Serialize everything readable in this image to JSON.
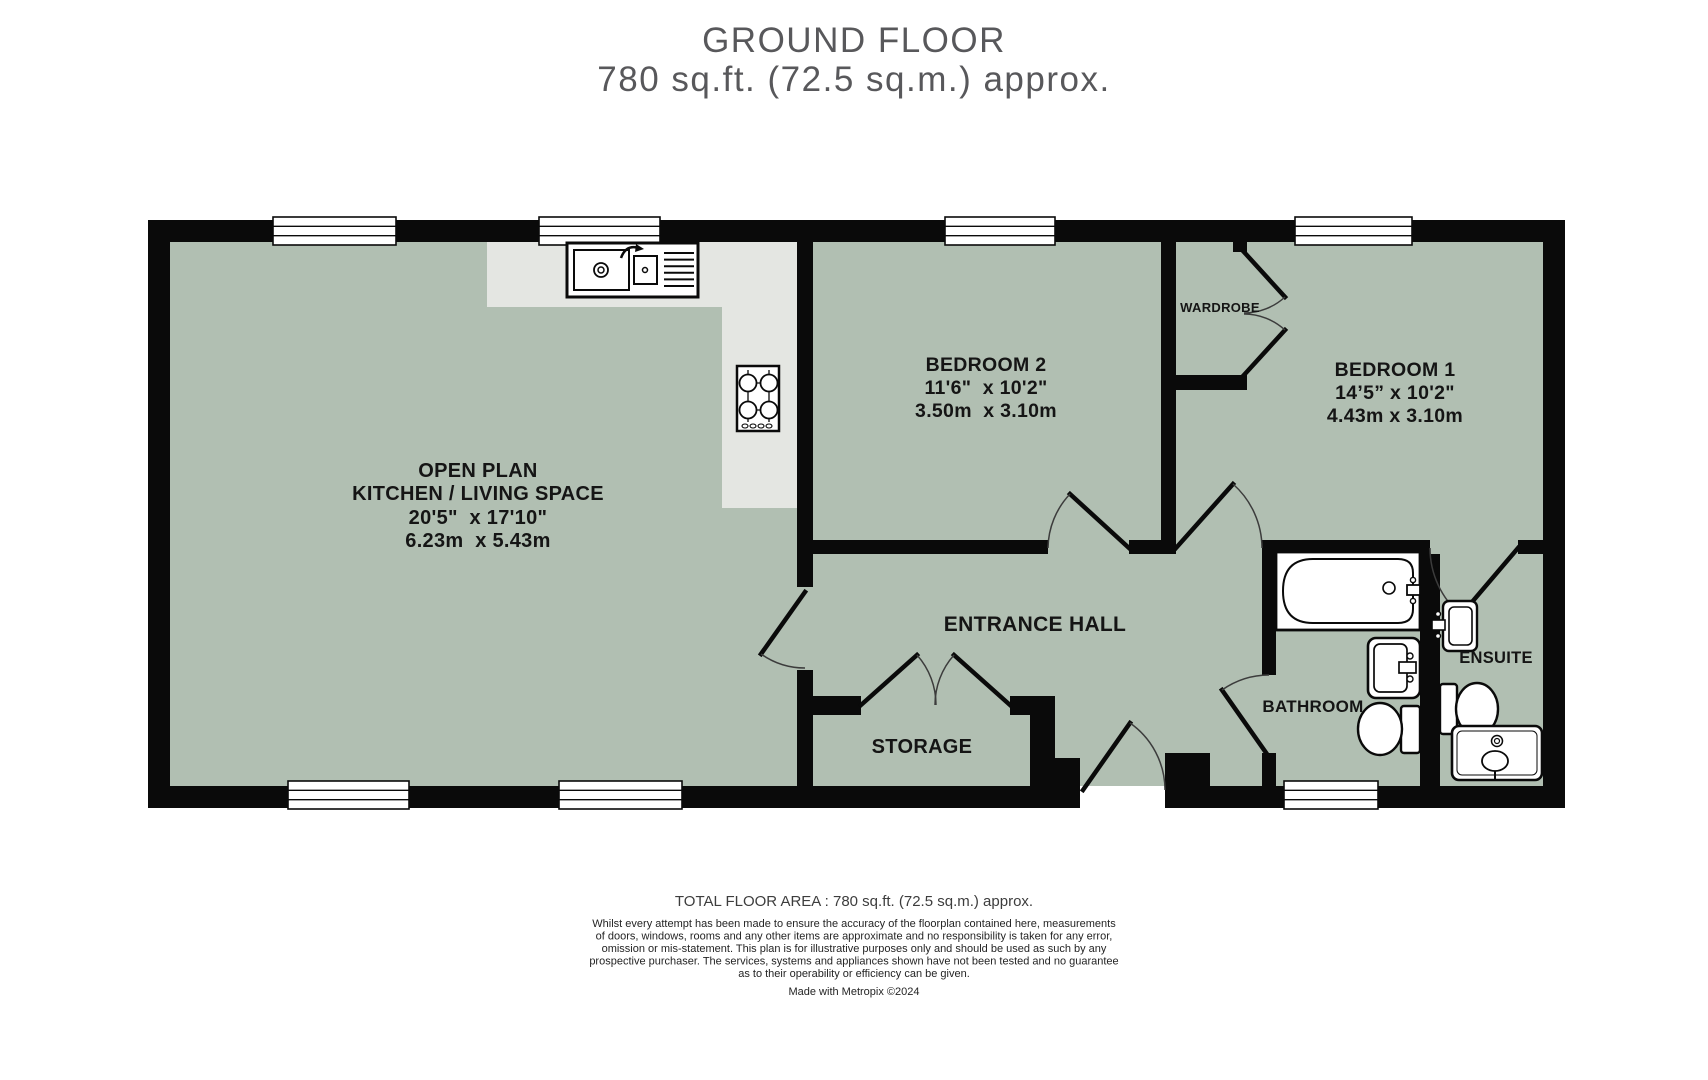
{
  "header": {
    "title": "GROUND FLOOR",
    "subtitle": "780 sq.ft. (72.5 sq.m.) approx."
  },
  "rooms": {
    "open_plan": {
      "name_line1": "OPEN PLAN",
      "name_line2": "KITCHEN / LIVING SPACE",
      "dims_imperial": "20'5\"  x 17'10\"",
      "dims_metric": "6.23m  x 5.43m"
    },
    "bedroom2": {
      "name": "BEDROOM 2",
      "dims_imperial": "11'6\"  x 10'2\"",
      "dims_metric": "3.50m  x 3.10m"
    },
    "bedroom1": {
      "name": "BEDROOM 1",
      "dims_imperial": "14’5” x 10'2\"",
      "dims_metric": "4.43m x 3.10m"
    },
    "entrance_hall": {
      "name": "ENTRANCE HALL"
    },
    "storage": {
      "name": "STORAGE"
    },
    "bathroom": {
      "name": "BATHROOM"
    },
    "ensuite": {
      "name": "ENSUITE"
    },
    "wardrobe": {
      "name": "WARDROBE"
    }
  },
  "fixtures": [
    "kitchen-sink",
    "hob",
    "bathtub",
    "bathroom-washbasin",
    "bathroom-toilet",
    "ensuite-washbasin",
    "ensuite-toilet",
    "shower-tray",
    "wardrobe-double-doors"
  ],
  "footer": {
    "total_area": "TOTAL FLOOR AREA : 780 sq.ft. (72.5 sq.m.) approx.",
    "disclaimer_lines": [
      "Whilst every attempt has been made to ensure the accuracy of the floorplan contained here, measurements",
      "of doors, windows, rooms and any other items are approximate and no responsibility is taken for any error,",
      "omission or mis-statement. This plan is for illustrative purposes only and should be used as such by any",
      "prospective purchaser. The services, systems and appliances shown have not been tested and no guarantee",
      "as to their operability or efficiency can be given."
    ],
    "credit": "Made with Metropix ©2024"
  },
  "colors": {
    "floor": "#b1bfb2",
    "counter": "#e4e6e2",
    "wall": "#0a0a0a",
    "title_text": "#58585b",
    "label_text": "#151515"
  }
}
